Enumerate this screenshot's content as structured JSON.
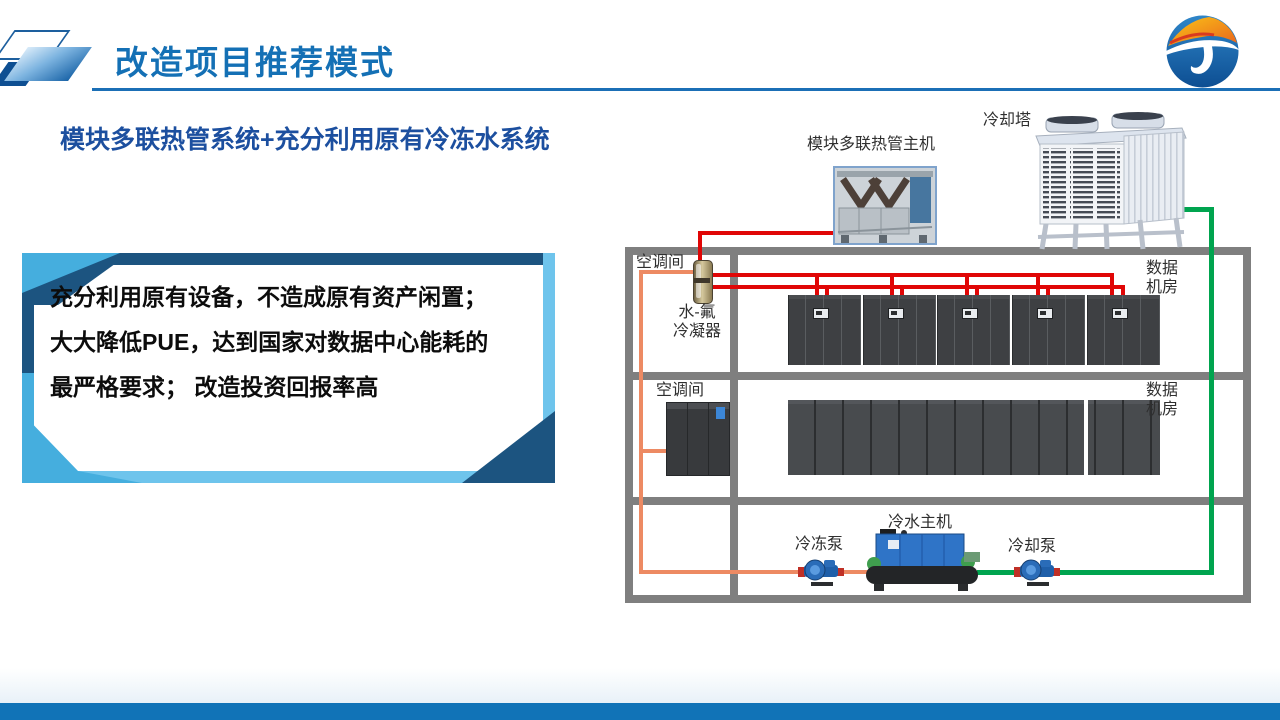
{
  "header": {
    "title": "改造项目推荐模式",
    "logo_name": "company-logo"
  },
  "subtitle": "模块多联热管系统+充分利用原有冷冻水系统",
  "key_box": {
    "line1": "充分利用原有设备，不造成原有资产闲置；",
    "line2": "大大降低PUE，达到国家对数据中心能耗的最严格要求；",
    "line3": "改造投资回报率高"
  },
  "diagram": {
    "heat_pipe_unit_label": "模块多联热管主机",
    "cooling_tower_label": "冷却塔",
    "room1": {
      "ac_room_label": "空调间",
      "condenser_label_line1": "水-氟",
      "condenser_label_line2": "冷凝器",
      "data_room_label_line1": "数据",
      "data_room_label_line2": "机房"
    },
    "room2": {
      "ac_room_label": "空调间",
      "data_room_label_line1": "数据",
      "data_room_label_line2": "机房"
    },
    "plant_room": {
      "chiller_label": "冷水主机",
      "chilled_water_pump_label": "冷冻泵",
      "cooling_water_pump_label": "冷却泵"
    },
    "pipe_colors": {
      "refrigerant_red": "#e00606",
      "chilled_water_orange": "#ed8a63",
      "cooling_water_green": "#00a44f",
      "room_frame_gray": "#7f7f7f"
    }
  },
  "theme": {
    "title_blue": "#1470b5",
    "subtitle_blue": "#1c4f9f",
    "footer_blue": "#1173b7",
    "box_frame_navy": "#1c5480",
    "box_frame_cyan": "#45aede"
  }
}
